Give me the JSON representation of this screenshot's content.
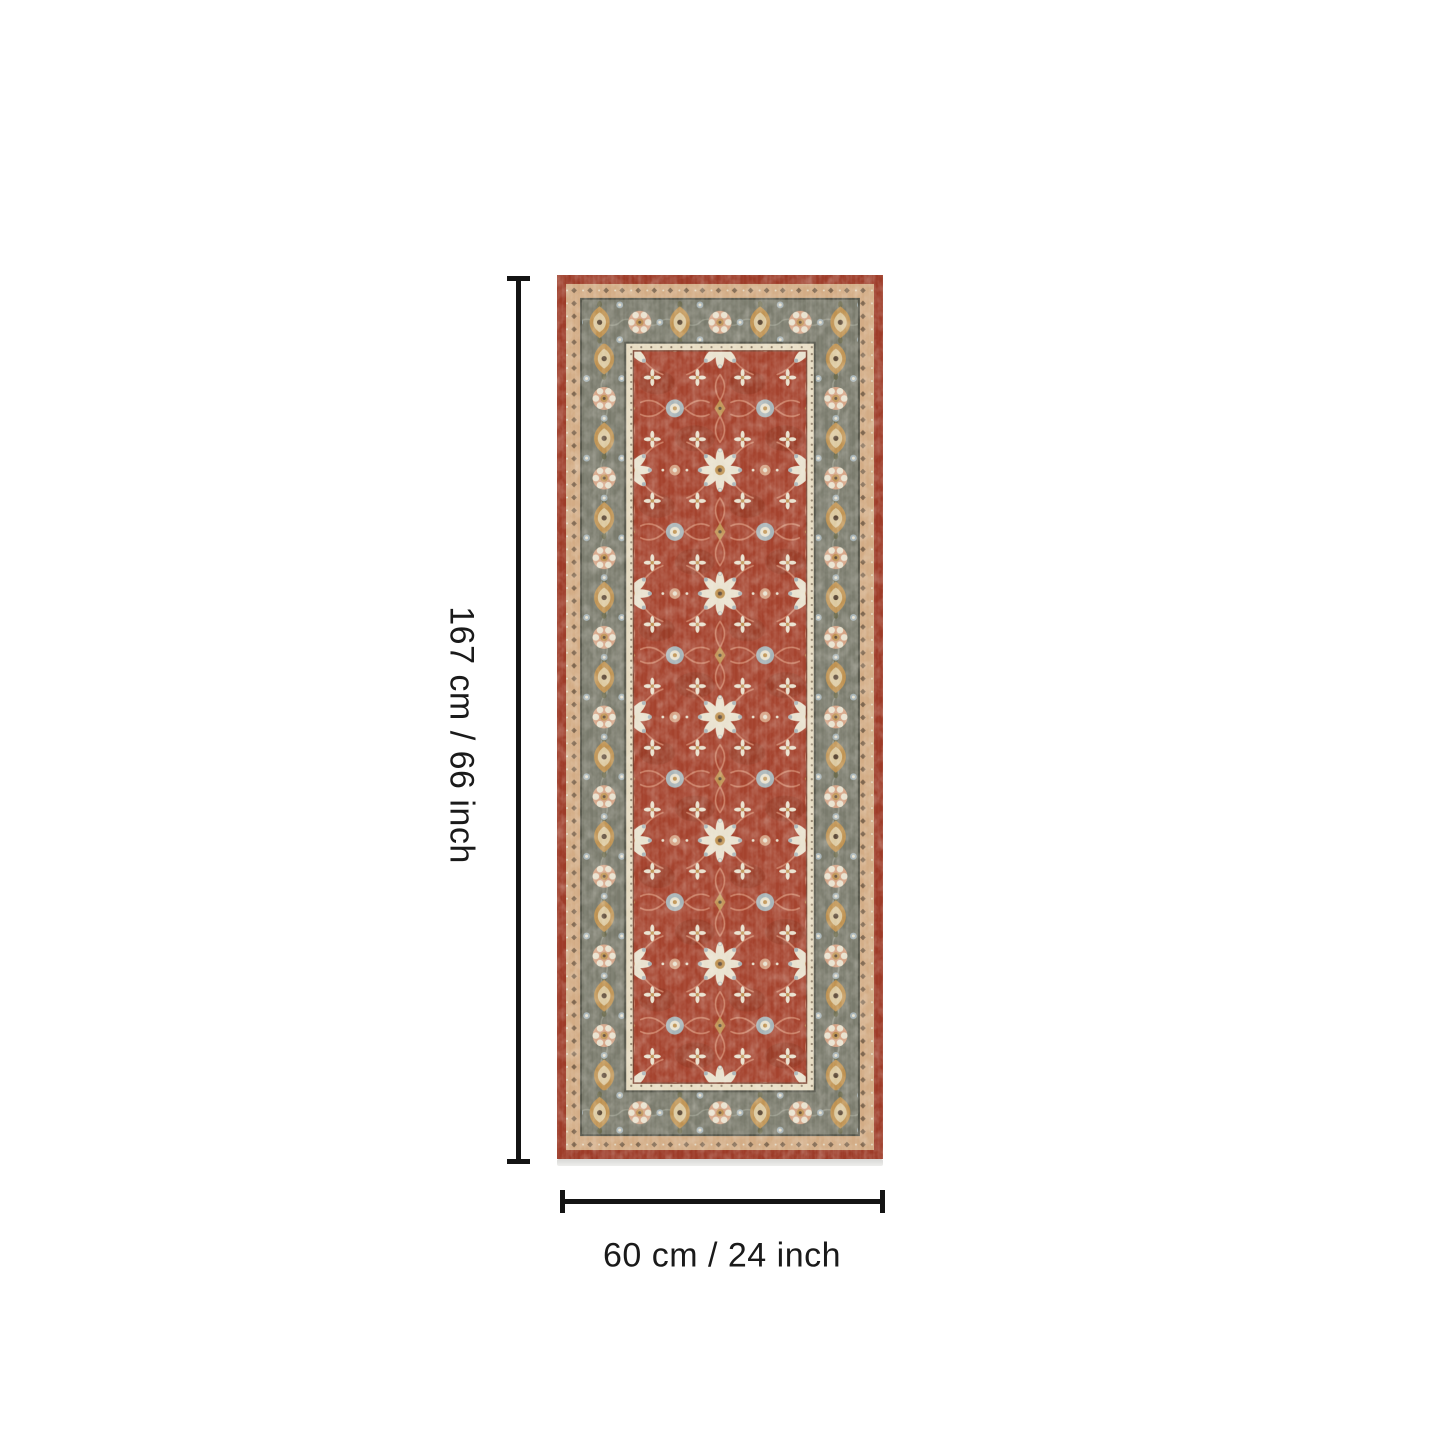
{
  "dimensions": {
    "height_label": "167 cm / 66 inch",
    "width_label": "60 cm / 24 inch"
  },
  "rug": {
    "description": "traditional oriental runner rug, red floral field with gray-green medallion border"
  },
  "colors": {
    "background": "#ffffff",
    "dimension_line": "#141414",
    "label_text": "#1a1a1a",
    "rug_outer_red": "#9d3b28",
    "rug_field_red": "#a5432e",
    "rug_field_red_dark": "#8d3522",
    "rug_border_green": "#7a7b6d",
    "rug_band_tan": "#d3ac85",
    "rug_guard_ivory": "#e7dcc2",
    "motif_gold": "#bf9251",
    "motif_gold_light": "#dcc9a0",
    "motif_peach": "#d5a284",
    "motif_blue": "#a7b4b8",
    "motif_ivory": "#e9e2cf",
    "motif_dark": "#5d4a38",
    "vine_salmon": "#cf8368",
    "border_dark_line": "#55564b",
    "field_edge_line": "#7a4433",
    "rug_shadow": "#d7d7d5"
  }
}
